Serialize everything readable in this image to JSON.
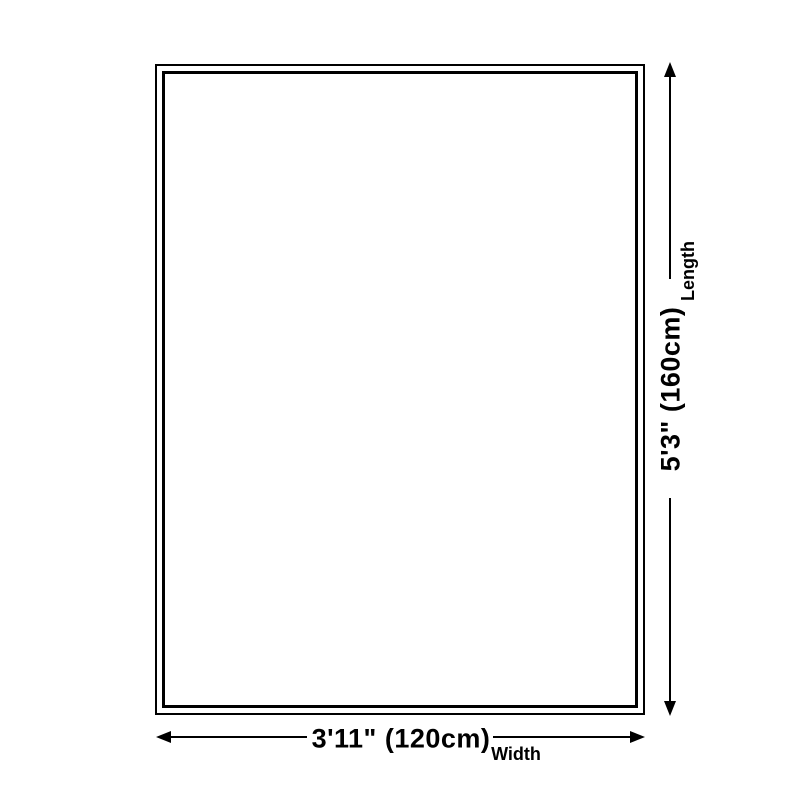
{
  "page": {
    "background": "#ffffff"
  },
  "diagram": {
    "type": "product-size-diagram",
    "colors": {
      "line": "#000000",
      "text": "#000000"
    },
    "length_dimension": {
      "value": "5'3\" (160cm)",
      "label": "Length"
    },
    "width_dimension": {
      "value": "3'11\" (120cm)",
      "label": "Width"
    }
  }
}
